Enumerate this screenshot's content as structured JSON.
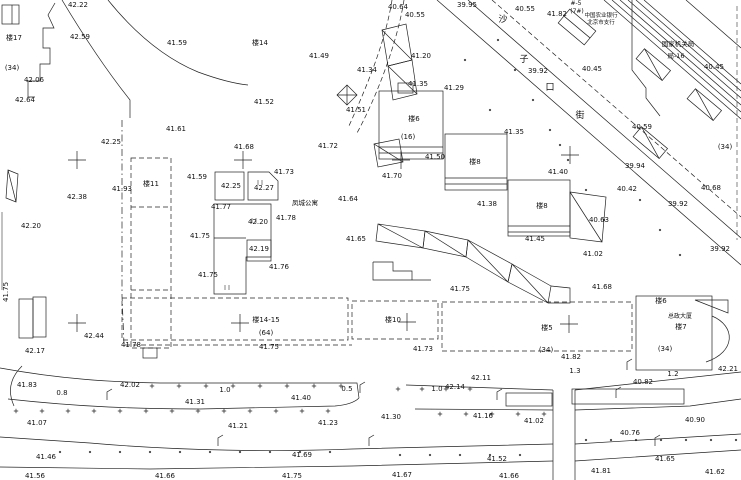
{
  "colors": {
    "ink": "#1c1c1c",
    "paper": "#ffffff",
    "hatch": "#444444"
  },
  "map": {
    "labels": [
      {
        "t": "楼17",
        "x": 14,
        "y": 40,
        "n": "building-number-label"
      },
      {
        "t": "(34)",
        "x": 12,
        "y": 70,
        "n": "floor-count-label"
      },
      {
        "t": "42.06",
        "x": 34,
        "y": 82
      },
      {
        "t": "42.64",
        "x": 25,
        "y": 102
      },
      {
        "t": "42.22",
        "x": 78,
        "y": 7
      },
      {
        "t": "42.59",
        "x": 80,
        "y": 39
      },
      {
        "t": "41.59",
        "x": 177,
        "y": 45
      },
      {
        "t": "41.61",
        "x": 176,
        "y": 131
      },
      {
        "t": "42.25",
        "x": 111,
        "y": 144
      },
      {
        "t": "41.93",
        "x": 122,
        "y": 191
      },
      {
        "t": "42.38",
        "x": 77,
        "y": 199
      },
      {
        "t": "42.20",
        "x": 31,
        "y": 228
      },
      {
        "t": "41.75",
        "x": 8,
        "y": 292,
        "rot": -90
      },
      {
        "t": "42.17",
        "x": 35,
        "y": 353
      },
      {
        "t": "42.44",
        "x": 94,
        "y": 338
      },
      {
        "t": "41.78",
        "x": 131,
        "y": 347
      },
      {
        "t": "41.83",
        "x": 27,
        "y": 387
      },
      {
        "t": "42.02",
        "x": 130,
        "y": 387
      },
      {
        "t": "0.8",
        "x": 62,
        "y": 395,
        "n": "distance-label"
      },
      {
        "t": "1.0",
        "x": 225,
        "y": 392,
        "n": "distance-label"
      },
      {
        "t": "41.31",
        "x": 195,
        "y": 404
      },
      {
        "t": "41.07",
        "x": 37,
        "y": 425
      },
      {
        "t": "41.21",
        "x": 238,
        "y": 428
      },
      {
        "t": "41.46",
        "x": 46,
        "y": 459
      },
      {
        "t": "41.56",
        "x": 35,
        "y": 478
      },
      {
        "t": "楼14",
        "x": 260,
        "y": 45,
        "n": "building-number-label"
      },
      {
        "t": "41.49",
        "x": 319,
        "y": 58
      },
      {
        "t": "41.52",
        "x": 264,
        "y": 104
      },
      {
        "t": "41.51",
        "x": 356,
        "y": 112
      },
      {
        "t": "41.72",
        "x": 328,
        "y": 148
      },
      {
        "t": "40.64",
        "x": 398,
        "y": 9
      },
      {
        "t": "40.55",
        "x": 415,
        "y": 17
      },
      {
        "t": "39.95",
        "x": 467,
        "y": 7
      },
      {
        "t": "41.34",
        "x": 367,
        "y": 72
      },
      {
        "t": "41.20",
        "x": 421,
        "y": 58
      },
      {
        "t": "41.35",
        "x": 418,
        "y": 86
      },
      {
        "t": "41.29",
        "x": 454,
        "y": 90
      },
      {
        "t": "41.64",
        "x": 348,
        "y": 201
      },
      {
        "t": "凤城公寓",
        "x": 305,
        "y": 205,
        "fs": 6.5,
        "n": "building-name-label"
      },
      {
        "t": "41.65",
        "x": 356,
        "y": 241
      },
      {
        "t": "41.68",
        "x": 244,
        "y": 149
      },
      {
        "t": "41.73",
        "x": 284,
        "y": 174
      },
      {
        "t": "41.59",
        "x": 197,
        "y": 179
      },
      {
        "t": "42.25",
        "x": 231,
        "y": 188
      },
      {
        "t": "42.27",
        "x": 264,
        "y": 190
      },
      {
        "t": "41.77",
        "x": 221,
        "y": 209
      },
      {
        "t": "42.20",
        "x": 258,
        "y": 224
      },
      {
        "t": "41.78",
        "x": 286,
        "y": 220
      },
      {
        "t": "41.75",
        "x": 200,
        "y": 238
      },
      {
        "t": "42.19",
        "x": 259,
        "y": 251
      },
      {
        "t": "41.76",
        "x": 279,
        "y": 269
      },
      {
        "t": "41.75",
        "x": 208,
        "y": 277
      },
      {
        "t": "楼11",
        "x": 151,
        "y": 186,
        "n": "building-number-label"
      },
      {
        "t": "沙",
        "x": 503,
        "y": 22,
        "fs": 9,
        "n": "street-name-char"
      },
      {
        "t": "子",
        "x": 524,
        "y": 62,
        "fs": 9,
        "n": "street-name-char"
      },
      {
        "t": "口",
        "x": 550,
        "y": 90,
        "fs": 9,
        "n": "street-name-char"
      },
      {
        "t": "街",
        "x": 580,
        "y": 118,
        "fs": 9,
        "n": "street-name-char"
      },
      {
        "t": "40.55",
        "x": 525,
        "y": 11
      },
      {
        "t": "41.82",
        "x": 557,
        "y": 16
      },
      {
        "t": "#-5",
        "x": 576,
        "y": 5,
        "fs": 6,
        "n": "building-number-label"
      },
      {
        "t": "(7#)",
        "x": 577,
        "y": 13,
        "fs": 6,
        "n": "floor-count-label"
      },
      {
        "t": "中国农业银行",
        "x": 601,
        "y": 17,
        "fs": 5.5,
        "n": "building-name-label"
      },
      {
        "t": "北京市支行",
        "x": 601,
        "y": 24,
        "fs": 5.5,
        "n": "building-name-label"
      },
      {
        "t": "国家机关局",
        "x": 678,
        "y": 46,
        "fs": 6.5,
        "n": "building-name-label"
      },
      {
        "t": "局-16",
        "x": 676,
        "y": 58,
        "fs": 6.5,
        "n": "building-number-label"
      },
      {
        "t": "39.92",
        "x": 538,
        "y": 73
      },
      {
        "t": "40.45",
        "x": 592,
        "y": 71
      },
      {
        "t": "40.45",
        "x": 714,
        "y": 69
      },
      {
        "t": "40.59",
        "x": 642,
        "y": 129
      },
      {
        "t": "(34)",
        "x": 725,
        "y": 149,
        "n": "floor-count-label"
      },
      {
        "t": "39.94",
        "x": 635,
        "y": 168
      },
      {
        "t": "40.42",
        "x": 627,
        "y": 191
      },
      {
        "t": "40.68",
        "x": 711,
        "y": 190
      },
      {
        "t": "39.92",
        "x": 678,
        "y": 206
      },
      {
        "t": "39.92",
        "x": 720,
        "y": 251
      },
      {
        "t": "40.63",
        "x": 599,
        "y": 222
      },
      {
        "t": "楼6",
        "x": 414,
        "y": 121,
        "n": "building-number-label"
      },
      {
        "t": "(16)",
        "x": 408,
        "y": 139,
        "n": "floor-count-label"
      },
      {
        "t": "41.50",
        "x": 435,
        "y": 159
      },
      {
        "t": "41.70",
        "x": 392,
        "y": 178
      },
      {
        "t": "41.35",
        "x": 514,
        "y": 134
      },
      {
        "t": "楼8",
        "x": 475,
        "y": 164,
        "n": "building-number-label"
      },
      {
        "t": "41.40",
        "x": 558,
        "y": 174
      },
      {
        "t": "41.38",
        "x": 487,
        "y": 206
      },
      {
        "t": "楼8",
        "x": 542,
        "y": 208,
        "n": "building-number-label"
      },
      {
        "t": "41.45",
        "x": 535,
        "y": 241
      },
      {
        "t": "41.02",
        "x": 593,
        "y": 256
      },
      {
        "t": "41.68",
        "x": 602,
        "y": 289
      },
      {
        "t": "41.75",
        "x": 460,
        "y": 291
      },
      {
        "t": "楼14-15",
        "x": 266,
        "y": 322,
        "n": "building-number-label"
      },
      {
        "t": "(64)",
        "x": 266,
        "y": 335,
        "n": "floor-count-label"
      },
      {
        "t": "41.75",
        "x": 269,
        "y": 349
      },
      {
        "t": "楼10",
        "x": 393,
        "y": 322,
        "n": "building-number-label"
      },
      {
        "t": "41.73",
        "x": 423,
        "y": 351
      },
      {
        "t": "楼5",
        "x": 547,
        "y": 330,
        "n": "building-number-label"
      },
      {
        "t": "(34)",
        "x": 546,
        "y": 352,
        "n": "floor-count-label"
      },
      {
        "t": "41.82",
        "x": 571,
        "y": 359
      },
      {
        "t": "楼6",
        "x": 661,
        "y": 303,
        "n": "building-number-label"
      },
      {
        "t": "总政大厦",
        "x": 680,
        "y": 318,
        "fs": 6,
        "n": "building-name-label"
      },
      {
        "t": "楼7",
        "x": 681,
        "y": 329,
        "n": "building-number-label"
      },
      {
        "t": "(34)",
        "x": 665,
        "y": 351,
        "n": "floor-count-label"
      },
      {
        "t": "42.21",
        "x": 728,
        "y": 371
      },
      {
        "t": "1.2",
        "x": 673,
        "y": 376,
        "n": "distance-label"
      },
      {
        "t": "1.3",
        "x": 575,
        "y": 373,
        "n": "distance-label"
      },
      {
        "t": "40.82",
        "x": 643,
        "y": 384
      },
      {
        "t": "42.11",
        "x": 481,
        "y": 380
      },
      {
        "t": "42.14",
        "x": 455,
        "y": 389
      },
      {
        "t": "1.0",
        "x": 437,
        "y": 391,
        "n": "distance-label"
      },
      {
        "t": "0.5",
        "x": 347,
        "y": 391,
        "n": "distance-label"
      },
      {
        "t": "41.40",
        "x": 301,
        "y": 400
      },
      {
        "t": "41.30",
        "x": 391,
        "y": 419
      },
      {
        "t": "41.16",
        "x": 483,
        "y": 418
      },
      {
        "t": "41.23",
        "x": 328,
        "y": 425
      },
      {
        "t": "41.02",
        "x": 534,
        "y": 423
      },
      {
        "t": "40.90",
        "x": 695,
        "y": 422
      },
      {
        "t": "40.76",
        "x": 630,
        "y": 435
      },
      {
        "t": "41.69",
        "x": 302,
        "y": 457
      },
      {
        "t": "41.52",
        "x": 497,
        "y": 461
      },
      {
        "t": "41.65",
        "x": 665,
        "y": 461
      },
      {
        "t": "41.66",
        "x": 165,
        "y": 478
      },
      {
        "t": "41.75",
        "x": 292,
        "y": 478
      },
      {
        "t": "41.67",
        "x": 402,
        "y": 477
      },
      {
        "t": "41.66",
        "x": 509,
        "y": 478
      },
      {
        "t": "41.81",
        "x": 601,
        "y": 473
      },
      {
        "t": "41.62",
        "x": 715,
        "y": 474
      }
    ],
    "crosses": [
      {
        "x": 77,
        "y": 160
      },
      {
        "x": 243,
        "y": 160
      },
      {
        "x": 401,
        "y": 160
      },
      {
        "x": 570,
        "y": 155
      },
      {
        "x": 77,
        "y": 323
      },
      {
        "x": 240,
        "y": 323
      },
      {
        "x": 407,
        "y": 322
      },
      {
        "x": 569,
        "y": 324
      }
    ],
    "lamps": [
      {
        "x": 107,
        "y": 400
      },
      {
        "x": 218,
        "y": 446
      },
      {
        "x": 360,
        "y": 393
      },
      {
        "x": 369,
        "y": 446
      },
      {
        "x": 497,
        "y": 400
      },
      {
        "x": 616,
        "y": 398
      },
      {
        "x": 655,
        "y": 446
      },
      {
        "x": 627,
        "y": 370
      }
    ],
    "tick_rows": [
      {
        "y": 386,
        "x1": 152,
        "x2": 344,
        "step": 27,
        "g": "+"
      },
      {
        "y": 389,
        "x1": 398,
        "x2": 470,
        "step": 24,
        "g": "+"
      },
      {
        "y": 411,
        "x1": 16,
        "x2": 330,
        "step": 26,
        "g": "+"
      },
      {
        "y": 414,
        "x1": 440,
        "x2": 548,
        "step": 26,
        "g": "+"
      },
      {
        "y": 440,
        "x1": 586,
        "x2": 738,
        "step": 25,
        "g": "."
      },
      {
        "y": 452,
        "x1": 60,
        "x2": 330,
        "step": 30,
        "g": "."
      },
      {
        "y": 455,
        "x1": 400,
        "x2": 545,
        "step": 30,
        "g": "."
      }
    ],
    "dots": [
      [
        498,
        40
      ],
      [
        515,
        70
      ],
      [
        533,
        100
      ],
      [
        550,
        130
      ],
      [
        568,
        160
      ],
      [
        586,
        190
      ],
      [
        604,
        220
      ],
      [
        640,
        200
      ],
      [
        660,
        230
      ],
      [
        680,
        255
      ],
      [
        465,
        60
      ],
      [
        490,
        110
      ],
      [
        560,
        145
      ]
    ]
  }
}
